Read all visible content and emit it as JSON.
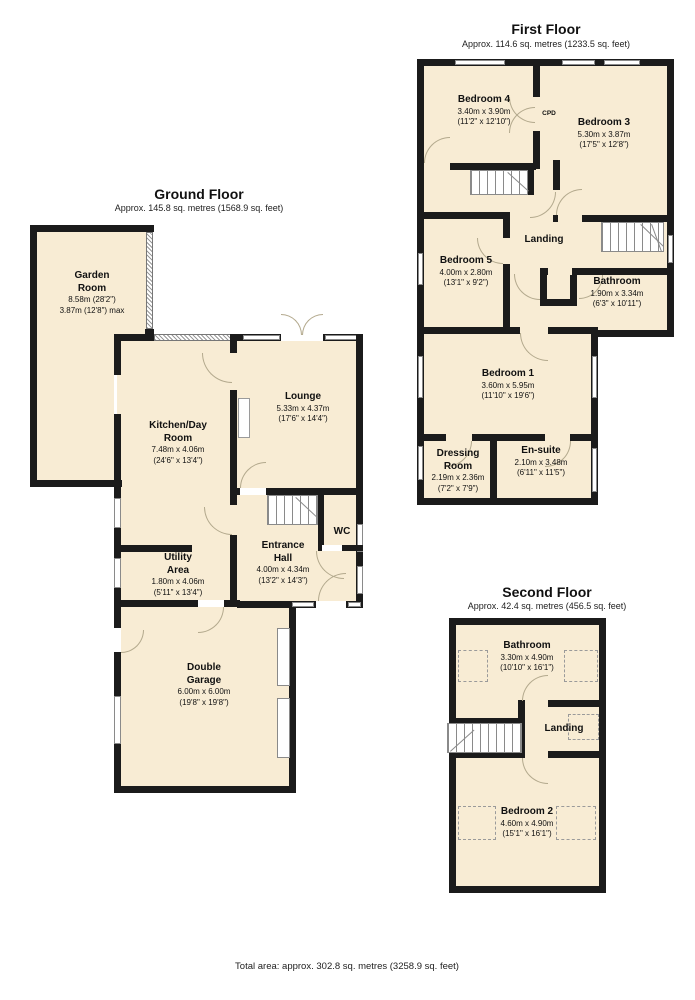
{
  "colors": {
    "room_fill": "#f8ecd4",
    "wall": "#1b1b1b",
    "door_arc": "#b3a98d",
    "window_border": "#8a8a8a"
  },
  "footer": {
    "total_area": "Total area: approx. 302.8 sq. metres (3258.9 sq. feet)"
  },
  "ground_floor": {
    "title": "Ground Floor",
    "subtitle": "Approx. 145.8 sq. metres (1568.9 sq. feet)",
    "rooms": {
      "garden_room": {
        "name": "Garden\nRoom",
        "dim1": "8.58m (28'2\")",
        "dim2": "3.87m (12'8\") max"
      },
      "kitchen_day_room": {
        "name": "Kitchen/Day\nRoom",
        "dim1": "7.48m x 4.06m",
        "dim2": "(24'6\" x 13'4\")"
      },
      "lounge": {
        "name": "Lounge",
        "dim1": "5.33m x 4.37m",
        "dim2": "(17'6\" x 14'4\")"
      },
      "entrance_hall": {
        "name": "Entrance\nHall",
        "dim1": "4.00m x 4.34m",
        "dim2": "(13'2\" x 14'3\")"
      },
      "wc": {
        "name": "WC"
      },
      "utility_area": {
        "name": "Utility\nArea",
        "dim1": "1.80m x 4.06m",
        "dim2": "(5'11\" x 13'4\")"
      },
      "double_garage": {
        "name": "Double\nGarage",
        "dim1": "6.00m x 6.00m",
        "dim2": "(19'8\" x 19'8\")"
      }
    }
  },
  "first_floor": {
    "title": "First Floor",
    "subtitle": "Approx. 114.6 sq. metres (1233.5 sq. feet)",
    "rooms": {
      "bedroom4": {
        "name": "Bedroom 4",
        "dim1": "3.40m x 3.90m",
        "dim2": "(11'2\" x 12'10\")"
      },
      "cpd": {
        "name": "CPD"
      },
      "bedroom3": {
        "name": "Bedroom 3",
        "dim1": "5.30m x 3.87m",
        "dim2": "(17'5\" x 12'8\")"
      },
      "landing": {
        "name": "Landing"
      },
      "bedroom5": {
        "name": "Bedroom 5",
        "dim1": "4.00m x 2.80m",
        "dim2": "(13'1\" x 9'2\")"
      },
      "bathroom": {
        "name": "Bathroom",
        "dim1": "1.90m x 3.34m",
        "dim2": "(6'3\" x 10'11\")"
      },
      "bedroom1": {
        "name": "Bedroom 1",
        "dim1": "3.60m x 5.95m",
        "dim2": "(11'10\" x 19'6\")"
      },
      "dressing_room": {
        "name": "Dressing\nRoom",
        "dim1": "2.19m x 2.36m",
        "dim2": "(7'2\" x 7'9\")"
      },
      "en_suite": {
        "name": "En-suite",
        "dim1": "2.10m x 3.48m",
        "dim2": "(6'11\" x 11'5\")"
      }
    }
  },
  "second_floor": {
    "title": "Second Floor",
    "subtitle": "Approx. 42.4 sq. metres (456.5 sq. feet)",
    "rooms": {
      "bathroom": {
        "name": "Bathroom",
        "dim1": "3.30m x 4.90m",
        "dim2": "(10'10\" x 16'1\")"
      },
      "landing": {
        "name": "Landing"
      },
      "bedroom2": {
        "name": "Bedroom 2",
        "dim1": "4.60m x 4.90m",
        "dim2": "(15'1\" x 16'1\")"
      }
    }
  }
}
